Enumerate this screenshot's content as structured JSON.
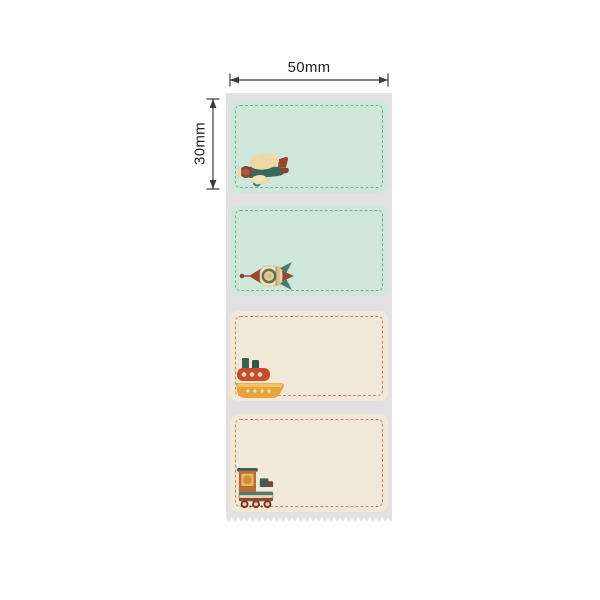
{
  "annotations": {
    "width_label": "50mm",
    "height_label": "30mm"
  },
  "colors": {
    "background": "#ffffff",
    "liner_strip": "#e2e0e3",
    "mint_label_bg": "#cfe7da",
    "mint_dashed_border": "#74b097",
    "cream_label_bg": "#f1e8d7",
    "cream_dashed_border": "#c08b5d",
    "dimension_lines": "#3a3a3a"
  },
  "strip": {
    "labels": [
      {
        "style": "mint",
        "icon": "airplane-icon"
      },
      {
        "style": "mint",
        "icon": "rocket-icon"
      },
      {
        "style": "cream",
        "icon": "boat-icon"
      },
      {
        "style": "cream",
        "icon": "train-icon"
      }
    ],
    "edge": "perforated-zigzag"
  }
}
